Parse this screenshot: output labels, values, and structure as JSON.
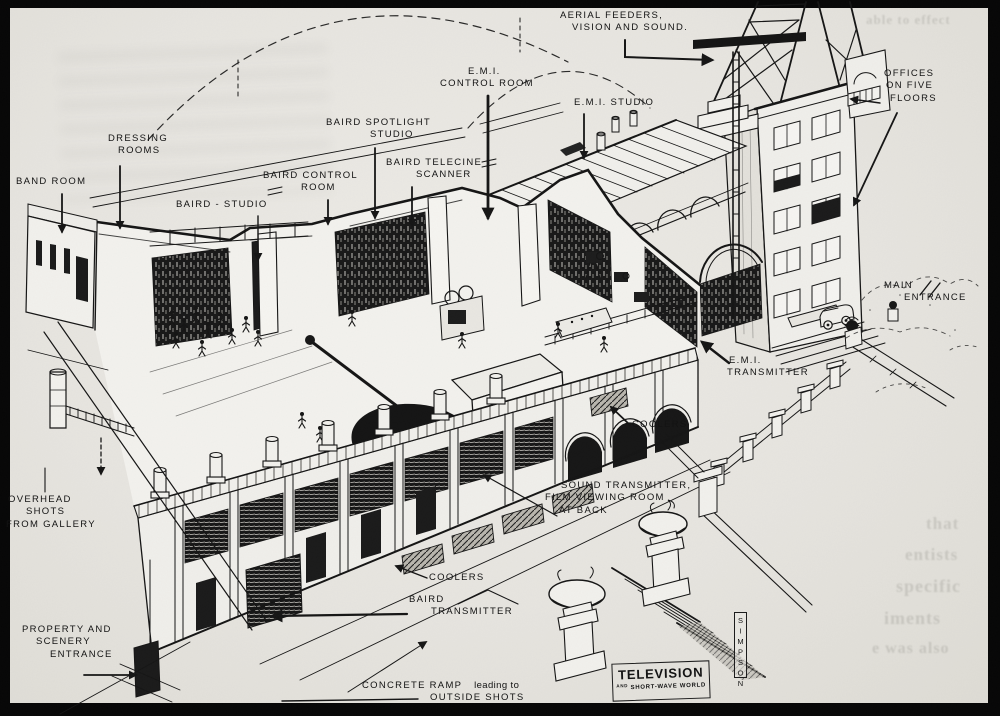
{
  "figure": {
    "subject": "Cutaway illustration of the television studios building with aerial mast",
    "style": "pen-and-ink isometric cutaway, magazine plate"
  },
  "labels": {
    "aerial_feeders": {
      "l1": "AERIAL FEEDERS,",
      "l2": "VISION AND SOUND."
    },
    "emi_control_room": {
      "l1": "E.M.I.",
      "l2": "CONTROL ROOM"
    },
    "emi_studio": {
      "l1": "E.M.I. STUDIO"
    },
    "baird_spotlight_studio": {
      "l1": "BAIRD SPOTLIGHT",
      "l2": "STUDIO"
    },
    "baird_telecine_scanner": {
      "l1": "BAIRD TELECINE",
      "l2": "SCANNER"
    },
    "baird_control_room": {
      "l1": "BAIRD CONTROL",
      "l2": "ROOM"
    },
    "baird_studio": {
      "l1": "BAIRD - STUDIO"
    },
    "dressing_rooms": {
      "l1": "DRESSING",
      "l2": "ROOMS"
    },
    "band_room": {
      "l1": "BAND ROOM"
    },
    "offices": {
      "l1": "OFFICES",
      "l2": "ON FIVE",
      "l3": "FLOORS"
    },
    "main_entrance": {
      "l1": "MAIN",
      "l2": "ENTRANCE"
    },
    "emi_transmitter": {
      "l1": "E.M.I.",
      "l2": "TRANSMITTER"
    },
    "coolers_upper": {
      "l1": "COOLERS"
    },
    "sound_transmitter": {
      "l1": "SOUND TRANSMITTER,",
      "l2": "FILM VIEWING ROOM",
      "l3": "AT BACK"
    },
    "coolers_lower": {
      "l1": "COOLERS"
    },
    "baird_transmitter": {
      "l1": "BAIRD",
      "l2": "TRANSMITTER"
    },
    "overhead_shots": {
      "l1": "OVERHEAD",
      "l2": "SHOTS",
      "l3": "FROM GALLERY"
    },
    "property_entrance": {
      "l1": "PROPERTY AND",
      "l2": "SCENERY",
      "l3": "ENTRANCE"
    },
    "concrete_ramp": {
      "caps1": "CONCRETE RAMP",
      "small": "leading to",
      "caps2": "OUTSIDE SHOTS"
    }
  },
  "logo": {
    "title": "TELEVISION",
    "and": "AND",
    "sub": "SHORT-WAVE WORLD"
  },
  "signature": "SIMPSON",
  "bleed": {
    "f1": "able to effect",
    "f2": "that",
    "f3": "entists",
    "f4": "specific",
    "f5": "iments",
    "f6": "e was also"
  },
  "colors": {
    "paper": "#e8e6e1",
    "ink": "#151515",
    "frame": "#060606"
  }
}
